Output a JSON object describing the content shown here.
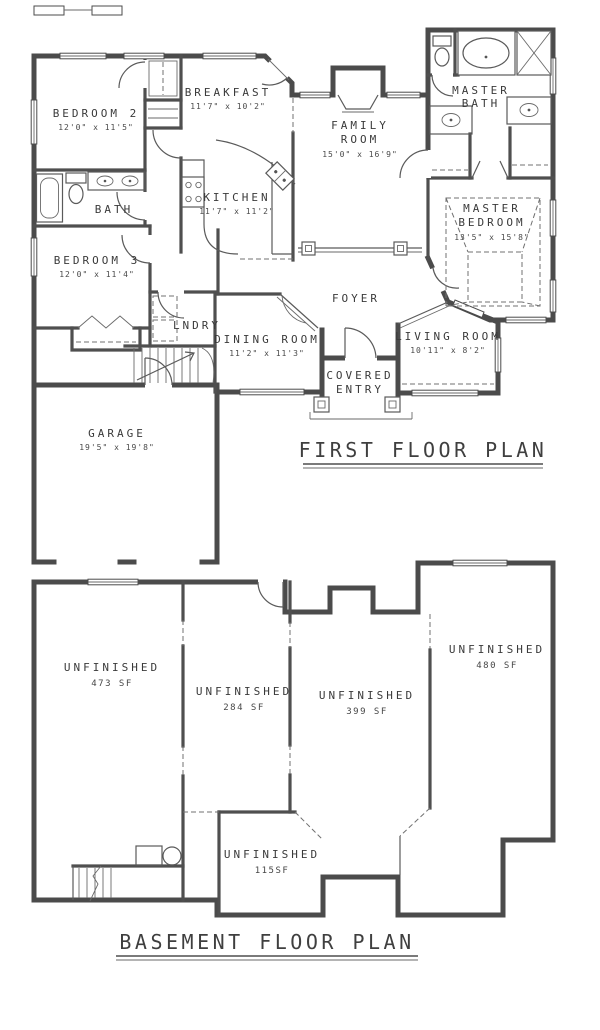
{
  "first_floor": {
    "title": "FIRST FLOOR PLAN",
    "rooms": [
      {
        "name": "BEDROOM 2",
        "lines": [
          "BEDROOM 2"
        ],
        "dims": "12'0\" x 11'5\""
      },
      {
        "name": "BREAKFAST",
        "lines": [
          "BREAKFAST"
        ],
        "dims": "11'7\" x 10'2\""
      },
      {
        "name": "FAMILY ROOM",
        "lines": [
          "FAMILY",
          "ROOM"
        ],
        "dims": "15'0\" x 16'9\""
      },
      {
        "name": "MASTER BATH",
        "lines": [
          "MASTER",
          "BATH"
        ]
      },
      {
        "name": "MASTER BEDROOM",
        "lines": [
          "MASTER",
          "BEDROOM"
        ],
        "dims": "13'5\" x 15'8\""
      },
      {
        "name": "BATH",
        "lines": [
          "BATH"
        ]
      },
      {
        "name": "KITCHEN",
        "lines": [
          "KITCHEN"
        ],
        "dims": "11'7\" x 11'2\""
      },
      {
        "name": "BEDROOM 3",
        "lines": [
          "BEDROOM 3"
        ],
        "dims": "12'0\" x 11'4\""
      },
      {
        "name": "LNDRY",
        "lines": [
          "LNDRY"
        ]
      },
      {
        "name": "DINING ROOM",
        "lines": [
          "DINING ROOM"
        ],
        "dims": "11'2\" x 11'3\""
      },
      {
        "name": "FOYER",
        "lines": [
          "FOYER"
        ]
      },
      {
        "name": "LIVING ROOM",
        "lines": [
          "LIVING ROOM"
        ],
        "dims": "10'11\" x 8'2\""
      },
      {
        "name": "COVERED ENTRY",
        "lines": [
          "COVERED",
          "ENTRY"
        ]
      },
      {
        "name": "GARAGE",
        "lines": [
          "GARAGE"
        ],
        "dims": "19'5\" x 19'8\""
      }
    ]
  },
  "basement": {
    "title": "BASEMENT FLOOR PLAN",
    "areas": [
      {
        "label": "UNFINISHED",
        "sf": "473 SF"
      },
      {
        "label": "UNFINISHED",
        "sf": "284 SF"
      },
      {
        "label": "UNFINISHED",
        "sf": "399 SF"
      },
      {
        "label": "UNFINISHED",
        "sf": "480 SF"
      },
      {
        "label": "UNFINISHED",
        "sf": "115SF"
      }
    ]
  },
  "colors": {
    "wall": "#4b4b4b",
    "paper": "#ffffff",
    "text": "#3a3a3a"
  }
}
